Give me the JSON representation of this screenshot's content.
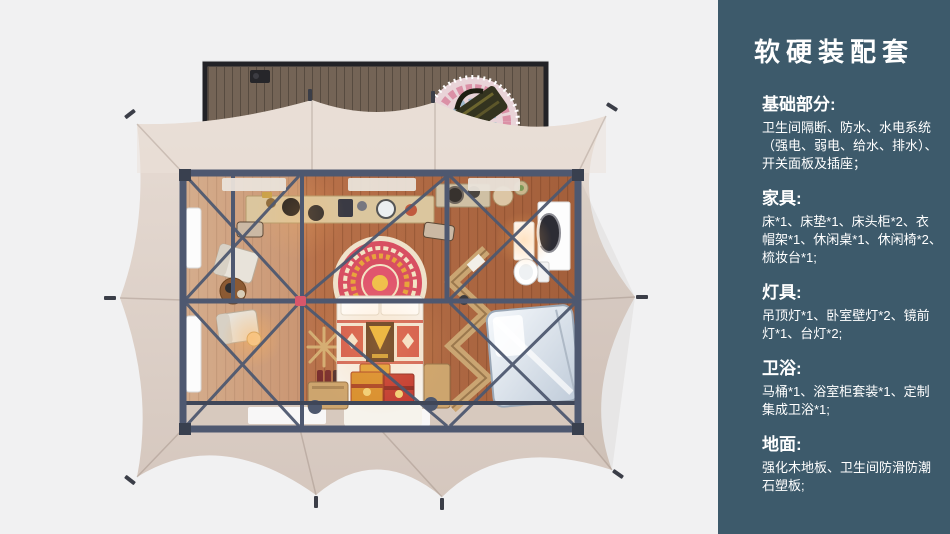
{
  "colors": {
    "background": "#f1f1f2",
    "sidebar_bg": "#3d5a6b",
    "sidebar_text": "#ffffff",
    "tent_canvas": "#ddd0c7",
    "steel_frame": "#4e5870",
    "wood_floor": "#b26d46",
    "deck_wood": "#746456",
    "accent_red": "#d8566b"
  },
  "sidebar": {
    "title": "软硬装配套",
    "sections": [
      {
        "heading": "基础部分:",
        "lines": [
          "卫生间隔断、防水、水电系统",
          "（强电、弱电、给水、排水）、",
          "开关面板及插座；"
        ]
      },
      {
        "heading": "家具:",
        "lines": [
          "床*1、床垫*1、床头柜*2、衣",
          "帽架*1、休闲桌*1、休闲椅*2、",
          "梳妆台*1;"
        ]
      },
      {
        "heading": "灯具:",
        "lines": [
          "吊顶灯*1、卧室壁灯*2、镜前",
          "灯*1、台灯*2;"
        ]
      },
      {
        "heading": "卫浴:",
        "lines": [
          "马桶*1、浴室柜套装*1、定制",
          "集成卫浴*1;"
        ]
      },
      {
        "heading": "地面:",
        "lines": [
          "强化木地板、卫生间防滑防潮",
          "石塑板;"
        ]
      }
    ]
  },
  "floor_plan": {
    "elements": [
      "deck",
      "picnic-blanket",
      "picnic-bag",
      "tent-canvas",
      "tent-stakes",
      "room-floor",
      "steel-frame",
      "bar-table",
      "bar-chairs",
      "windows",
      "lounge-chairs",
      "side-table",
      "floor-lamp",
      "coat-rack",
      "bed",
      "mandala-rug",
      "bed-chests",
      "nightstands",
      "zigzag-shelf",
      "dressing-table",
      "bathroom-vanity",
      "toilet",
      "bathroom-pod",
      "white-mats"
    ]
  }
}
